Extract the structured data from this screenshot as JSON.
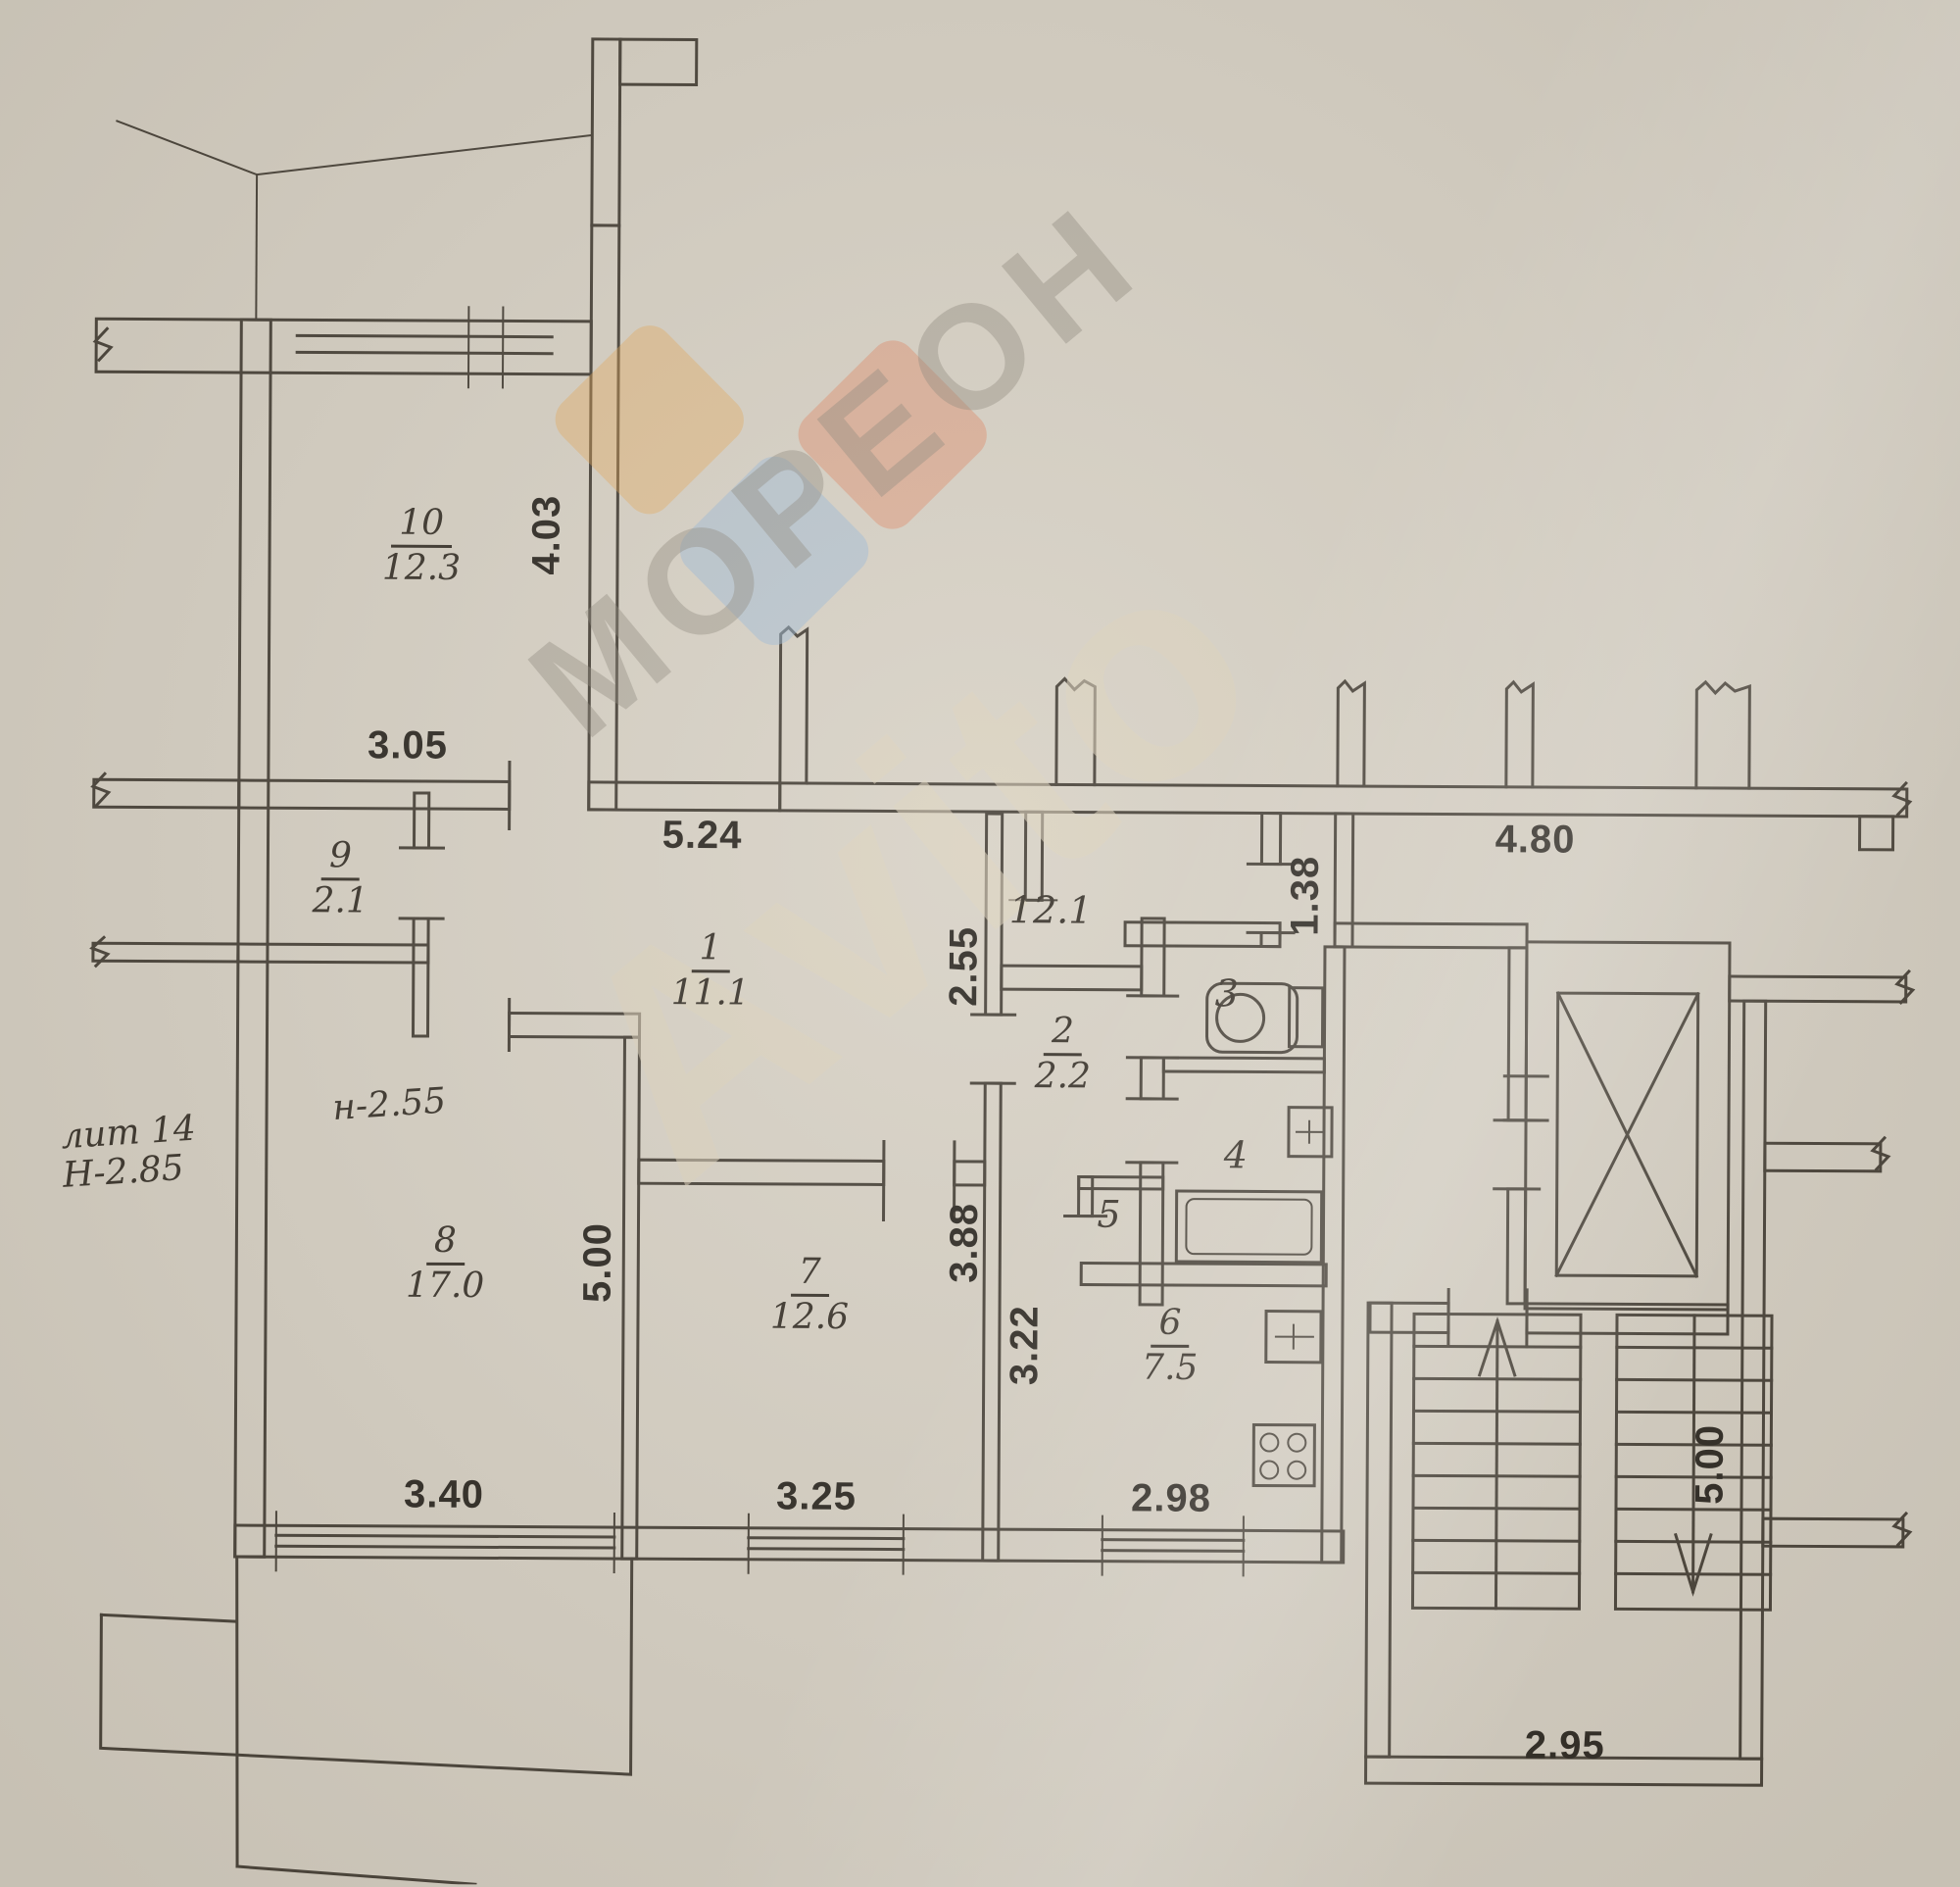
{
  "plan": {
    "rooms": {
      "r10": {
        "number": "10",
        "area": "12.3"
      },
      "r9": {
        "number": "9",
        "area": "2.1"
      },
      "r1": {
        "number": "1",
        "area": "11.1"
      },
      "r8": {
        "number": "8",
        "area": "17.0"
      },
      "r7": {
        "number": "7",
        "area": "12.6"
      },
      "r2": {
        "number": "2",
        "area": "2.2"
      },
      "r6": {
        "number": "6",
        "area": "7.5"
      },
      "r3": {
        "number": "3"
      },
      "r4": {
        "number": "4"
      },
      "r5": {
        "number": "5"
      },
      "hall": {
        "number": "12.1"
      }
    },
    "dimensions": {
      "room10_height": "4.03",
      "room10_width": "3.05",
      "corridor_width": "5.24",
      "corridor_height": "2.55",
      "vestibule_length": "1.38",
      "hallway_width": "4.80",
      "room8_height": "5.00",
      "room8_width": "3.40",
      "room7_height": "3.88",
      "room7_width": "3.25",
      "kitchen_height": "3.22",
      "kitchen_width": "2.98",
      "stairs_height": "5.00",
      "stairs_width": "2.95"
    },
    "notes": {
      "liter": "лит 14",
      "building_height": "Н-2.85",
      "ceiling_height": "н-2.55"
    },
    "watermarks": {
      "brand": "МОРЕОН",
      "marketplace": "Avito"
    },
    "colors": {
      "paper": "#d7d1c5",
      "ink": "#49433a",
      "label_ink": "#3a342c",
      "dimension_ink": "#2e2a24",
      "watermark_orange": "#e8a855",
      "watermark_blue": "#9db9d8",
      "watermark_red": "#e08968",
      "watermark_gray": "#8d877b",
      "watermark_light": "#ded4bd"
    }
  }
}
